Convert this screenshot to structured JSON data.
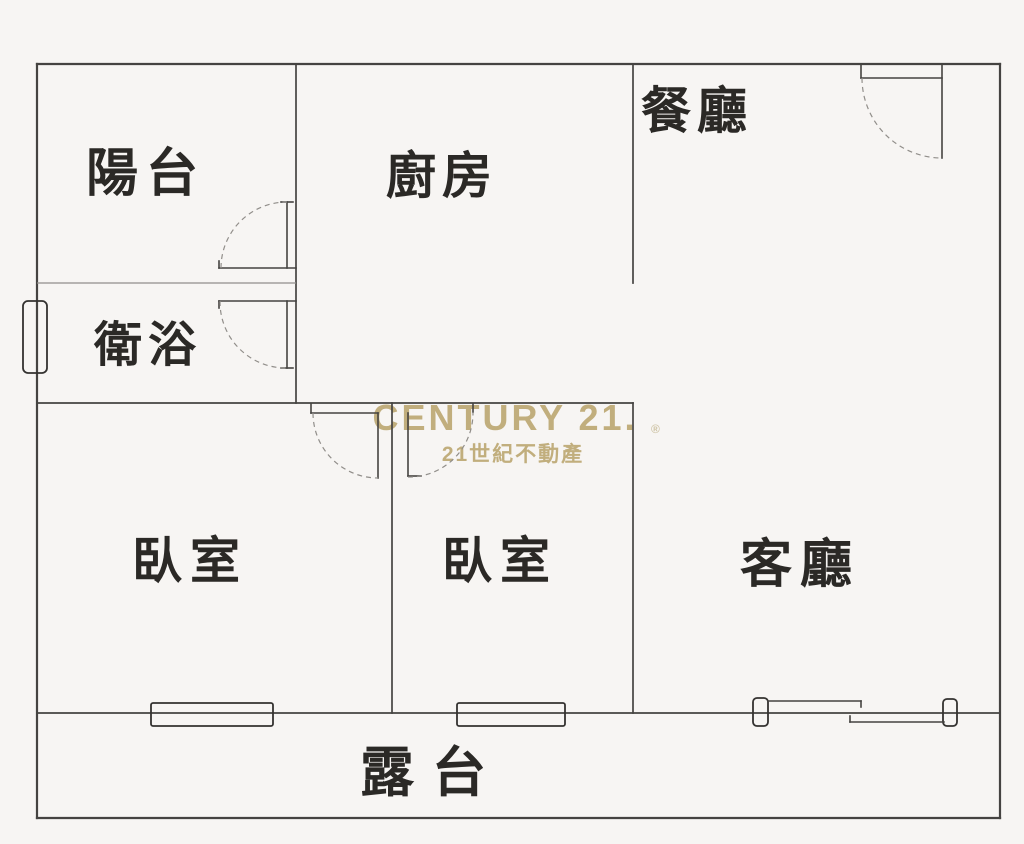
{
  "watermark": {
    "brand": "CENTURY 21.",
    "registered": "®",
    "subtitle": "21世紀不動產"
  },
  "rooms": {
    "balcony": {
      "label": "陽台"
    },
    "kitchen": {
      "label": "廚房"
    },
    "dining": {
      "label": "餐廳"
    },
    "bathroom": {
      "label": "衛浴"
    },
    "bedroom1": {
      "label": "臥室"
    },
    "bedroom2": {
      "label": "臥室"
    },
    "living": {
      "label": "客廳"
    },
    "terrace": {
      "label": "露台"
    }
  },
  "colors": {
    "background": "#f7f5f3",
    "wall": "#454341",
    "wall_light": "#918e8a",
    "window": "#343230",
    "text": "#2b2926",
    "watermark_gold": "#c1ae7d",
    "watermark_light": "#cfc4a6"
  }
}
